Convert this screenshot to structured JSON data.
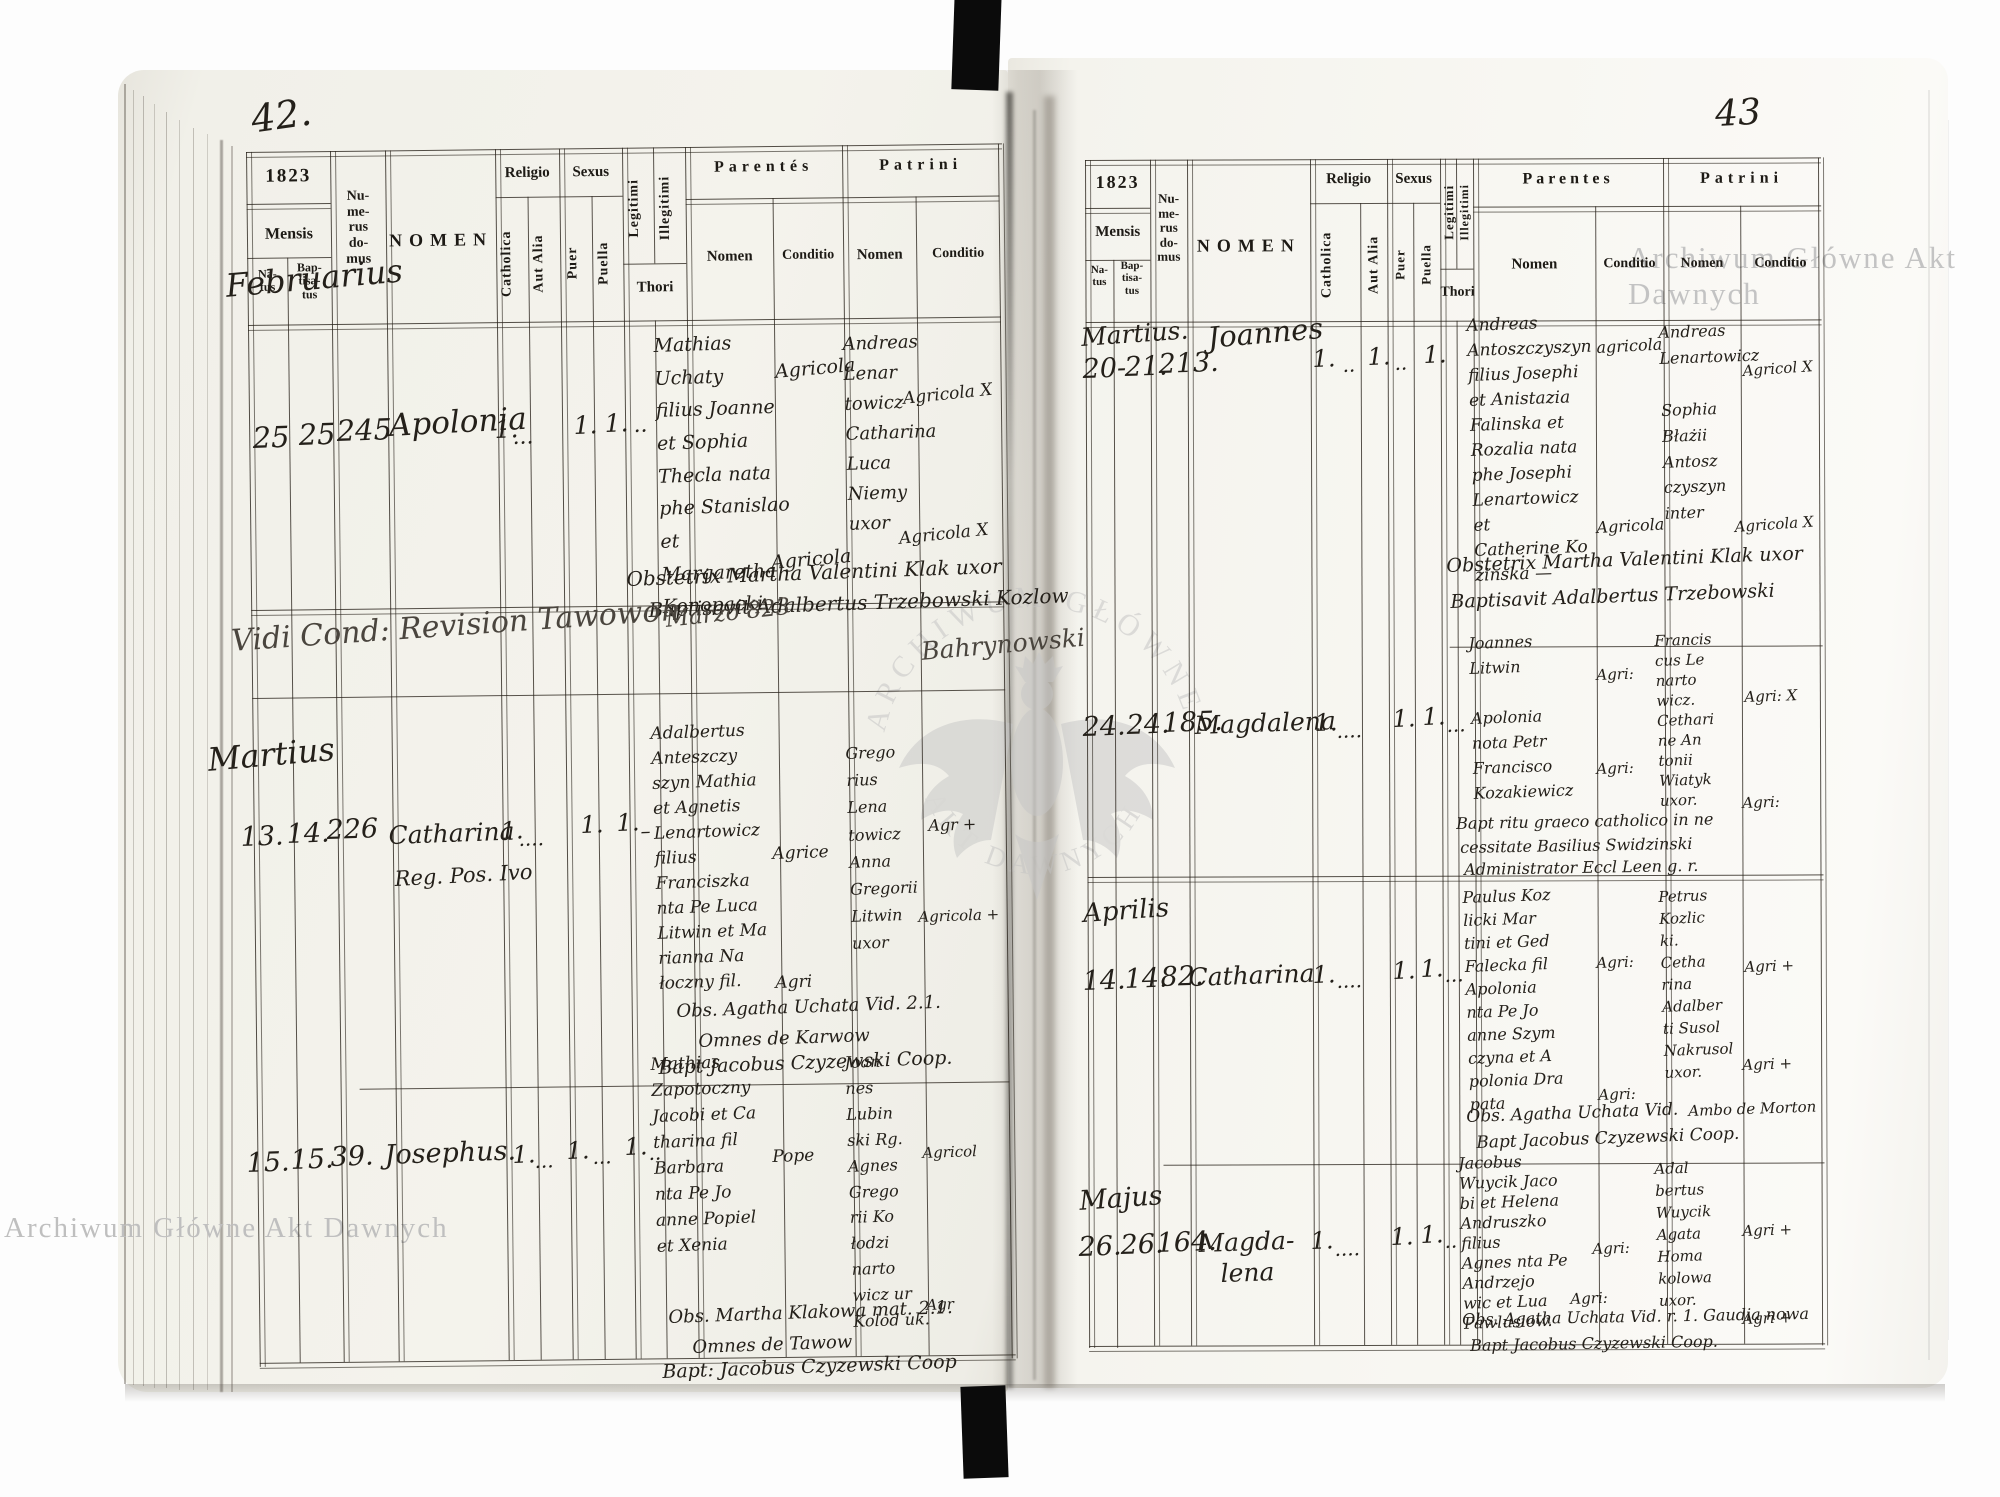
{
  "watermarks": {
    "top_right": "Archiwum Główne Akt Dawnych",
    "bottom_left": "Archiwum Główne Akt Dawnych",
    "seal_top": "ARCHIWUM GŁÓWNE",
    "seal_bottom": "AKT DAWNYCH"
  },
  "form": {
    "year": "1823",
    "mensis": "Mensis",
    "natus": "Na-\ntus",
    "baptisatus": "Bap-\ntisa-\ntus",
    "numerus_domus": "Nu-\nme-\nrus\ndo-\nmus",
    "nomen": "NOMEN",
    "religio": "Religio",
    "catholica": "Catholica",
    "aut_alia": "Aut Alia",
    "sexus": "Sexus",
    "puer": "Puer",
    "puella": "Puella",
    "legitimi": "Legitimi",
    "illegitimi": "Illegitimi",
    "thori": "Thori",
    "parentes_left": "Parentés",
    "parentes_right": "Parentes",
    "patrini": "Patrini",
    "sub_nomen": "Nomen",
    "sub_conditio": "Conditio"
  },
  "left": {
    "folio": "42.",
    "month_februarius": "Februarius",
    "month_martius": "Martius",
    "r1": {
      "natus": "25",
      "baptisatus": "25",
      "domus": "245",
      "nomen": "Apolonia",
      "catholica": "1.",
      "aut_alia": "...",
      "puella": "1.",
      "legitimi": "1.",
      "thori": "..",
      "parentes_nomen": "Mathias\nUchaty\nfilius Joanne\net Sophia\nThecla nata\nphe Stanislao\net Margaretha\nKonopacki",
      "parentes_conditio_a": "Agricola",
      "parentes_conditio_b": "Agricola",
      "patrini_nomen": "Andreas\nLenar\ntowicz\nCatharina\nLuca\nNiemy\nuxor",
      "patrini_conditio_a": "Agricola X",
      "patrini_conditio_b": "Agricola X",
      "obstetrix": "Obstetrix Martha Valentini Klak uxor",
      "baptisavit": "Baptisavit Adalbertus Trzebowski Kozlow"
    },
    "revision_note": {
      "vidi": "Vidi Cond: Revision Tawowon",
      "marzo": "Marzo 823",
      "signature": "Bahrynowski"
    },
    "r2": {
      "natus": "13.",
      "baptisatus": "14.",
      "domus": "226",
      "nomen": "Catharina",
      "nomen_sub": "Reg. Pos. Ivo",
      "catholica": "1.",
      "aut_alia": "....",
      "puella": "1.",
      "legitimi": "1.",
      "thori": "–",
      "parentes_nomen": "Adalbertus\nAnteszczy\nszyn Mathia\net Agnetis\nLenartowicz\nfilius\nFranciszka\nnta Pe Luca\nLitwin et Ma\nrianna Na\nłoczny fil.",
      "parentes_conditio_a": "Agrice",
      "parentes_conditio_b": "Agri",
      "patrini_nomen": "Grego\nrius\nLena\ntowicz\nAnna\nGregorii\nLitwin\nuxor",
      "patrini_conditio_a": "Agr +",
      "patrini_conditio_b": "Agricola +",
      "obs": "Obs. Agatha Uchata Vid. 2.1.",
      "omnes": "Omnes de Karwow",
      "bapt": "Bapt Jacobus Czyzewski Coop."
    },
    "r3": {
      "natus": "15.",
      "baptisatus": "15.",
      "domus": "39.",
      "nomen": "Josephus.",
      "catholica": "1.",
      "aut_alia": "...",
      "puer": "1.",
      "puella": "...",
      "legitimi": "1.",
      "thori": "..",
      "parentes_nomen": "Mathias\nZapotoczny\nJacobi et Ca\ntharina fil\nBarbara\nnta Pe Jo\nanne Popiel\net Xenia",
      "parentes_conditio_a": "Pope",
      "patrini_nomen": "Joan\nnes\nLubin\nski Rg.\nAgnes\nGrego\nrii Ko\nłodzi\nnarto\nwicz ur\nKolod uk.",
      "patrini_conditio_a": "Agricol",
      "patrini_conditio_b": "Agr",
      "obs": "Obs. Martha Klakowa mat. 2.1.",
      "omnes": "Omnes de Tawow",
      "bapt": "Bapt: Jacobus Czyzewski Coop"
    }
  },
  "right": {
    "folio": "43",
    "month_martius": "Martius.",
    "month_aprilis": "Aprilis",
    "month_majus": "Majus",
    "r1": {
      "natus": "20-",
      "baptisatus": "21.",
      "domus": "213.",
      "nomen": "Joannes",
      "catholica": "1.",
      "aut_alia": "..",
      "puer": "1.",
      "puella": "..",
      "legitimi": "1.",
      "parentes_nomen": "Andreas\nAntoszczyszyn\nfilius Josephi\net Anistazia\nFalinska et\nRozalia nata\nphe Josephi\nLenartowicz et\nCatherine Ko\nzinska —",
      "parentes_conditio_a": "agricola",
      "parentes_conditio_b": "Agricola",
      "patrini_nomen": "Andreas\nLenartowicz\n\nSophia\nBłażii\nAntosz\nczyszyn\ninter",
      "patrini_conditio_a": "Agricol X",
      "patrini_conditio_b": "Agricola X",
      "obstetrix": "Obstetrix Martha Valentini Klak uxor",
      "baptisavit": "Baptisavit Adalbertus Trzebowski"
    },
    "r2": {
      "natus": "24.",
      "baptisatus": "24.",
      "domus": "185.",
      "nomen": "Magdalena",
      "catholica": "1.",
      "aut_alia": "....",
      "puella": "1.",
      "legitimi": "1.",
      "thori": "...",
      "parentes_nomen": "Joannes\nLitwin\n\nApolonia\nnota Petr\nFrancisco\nKozakiewicz",
      "parentes_conditio_a": "Agri:",
      "parentes_conditio_b": "Agri:",
      "patrini_nomen": "Francis\ncus Le\nnarto\nwicz.\nCethari\nne An\ntonii\nWiatyk\nuxor.",
      "patrini_conditio_a": "Agri: X",
      "patrini_conditio_b": "Agri:",
      "note1": "Bapt ritu graeco catholico in ne",
      "note2": "cessitate Basilius Swidzinski",
      "note3": "Administrator Eccl Leen g. r."
    },
    "r3": {
      "natus": "14.",
      "baptisatus": "14.",
      "domus": "82.",
      "nomen": "Catharina",
      "catholica": "1.",
      "aut_alia": "....",
      "puella": "1.",
      "legitimi": "1.",
      "thori": "...",
      "parentes_nomen": "Paulus Koz\nlicki Mar\ntini et Ged\nFalecka fil\nApolonia\nnta Pe Jo\nanne Szym\nczyna et A\npolonia Dra\npata",
      "parentes_conditio_a": "Agri:",
      "parentes_conditio_b": "Agri:",
      "patrini_nomen": "Petrus\nKozlic\nki.\nCetha\nrina\nAdalber\nti Susol\nNakrusol\nuxor.",
      "patrini_conditio_a": "Agri +",
      "patrini_conditio_b": "Agri +",
      "ambo": "Ambo de Morton",
      "obs": "Obs. Agatha Uchata Vid.",
      "bapt": "Bapt Jacobus Czyzewski Coop."
    },
    "r4": {
      "natus": "26.",
      "baptisatus": "26.",
      "domus": "164.",
      "nomen": "Magda-",
      "nomen2": "lena",
      "catholica": "1.",
      "aut_alia": "....",
      "puella": "1.",
      "legitimi": "1.",
      "thori": "..",
      "parentes_nomen": "Jacobus\nWuycik Jaco\nbi et Helena\nAndruszko\nfilius\nAgnes nta Pe\nAndrzejo\nwic et Lua\nPawlusiow.",
      "parentes_conditio_a": "Agri:",
      "parentes_conditio_b": "Agri:",
      "patrini_nomen": "Adal\nbertus\nWuycik\nAgata\nHoma\nkolowa\nuxor.",
      "patrini_conditio_a": "Agri +",
      "patrini_conditio_b": "Agri +",
      "obs": "Obs. Agatha Uchata Vid. r. 1. Gaudia nowa",
      "bapt": "Bapt Jacobus Czyzewski Coop."
    }
  }
}
